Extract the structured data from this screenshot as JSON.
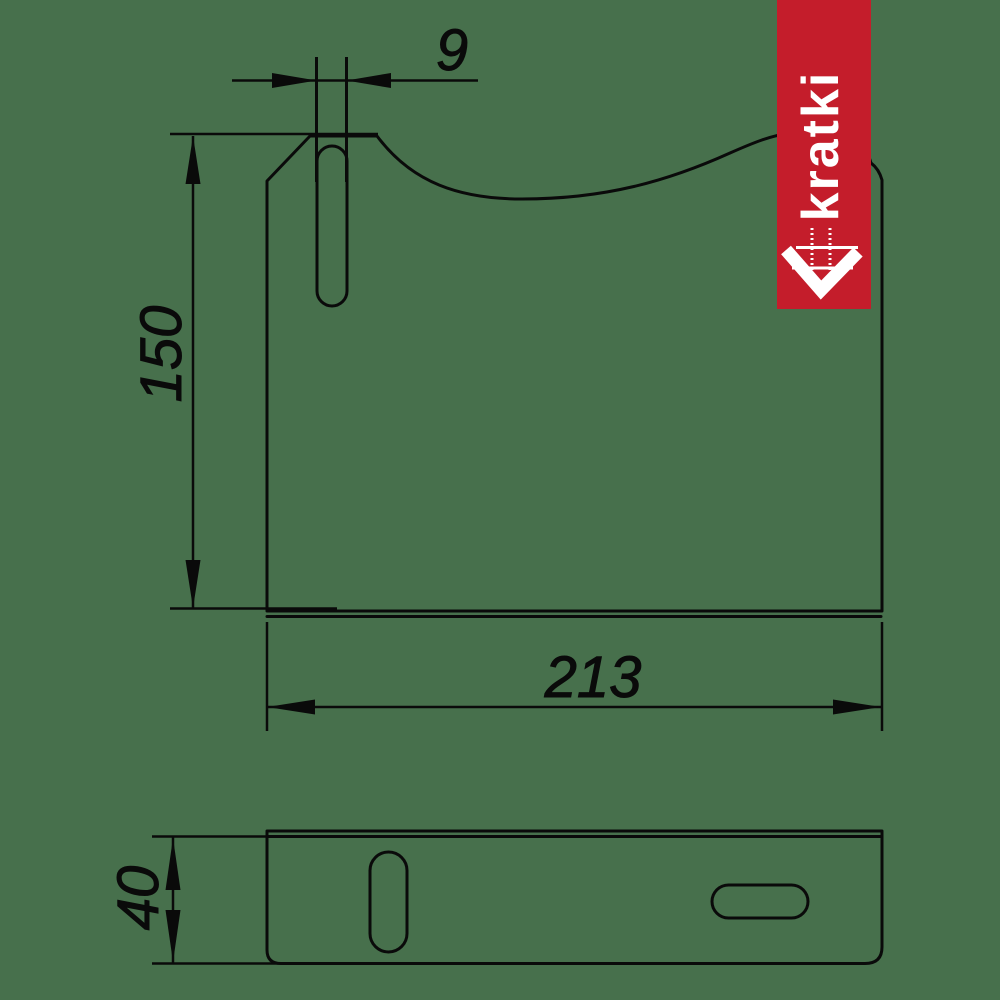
{
  "title": "bracket-two-view-technical-drawing",
  "colors": {
    "background": "#47704c",
    "line": "#0a0a0a",
    "banner_red": "#c41d2b",
    "banner_text": "#ffffff"
  },
  "brand": {
    "name": "kratki"
  },
  "dimensions": {
    "slot_width": "9",
    "plate_height": "150",
    "plate_width": "213",
    "flange_depth": "40"
  }
}
